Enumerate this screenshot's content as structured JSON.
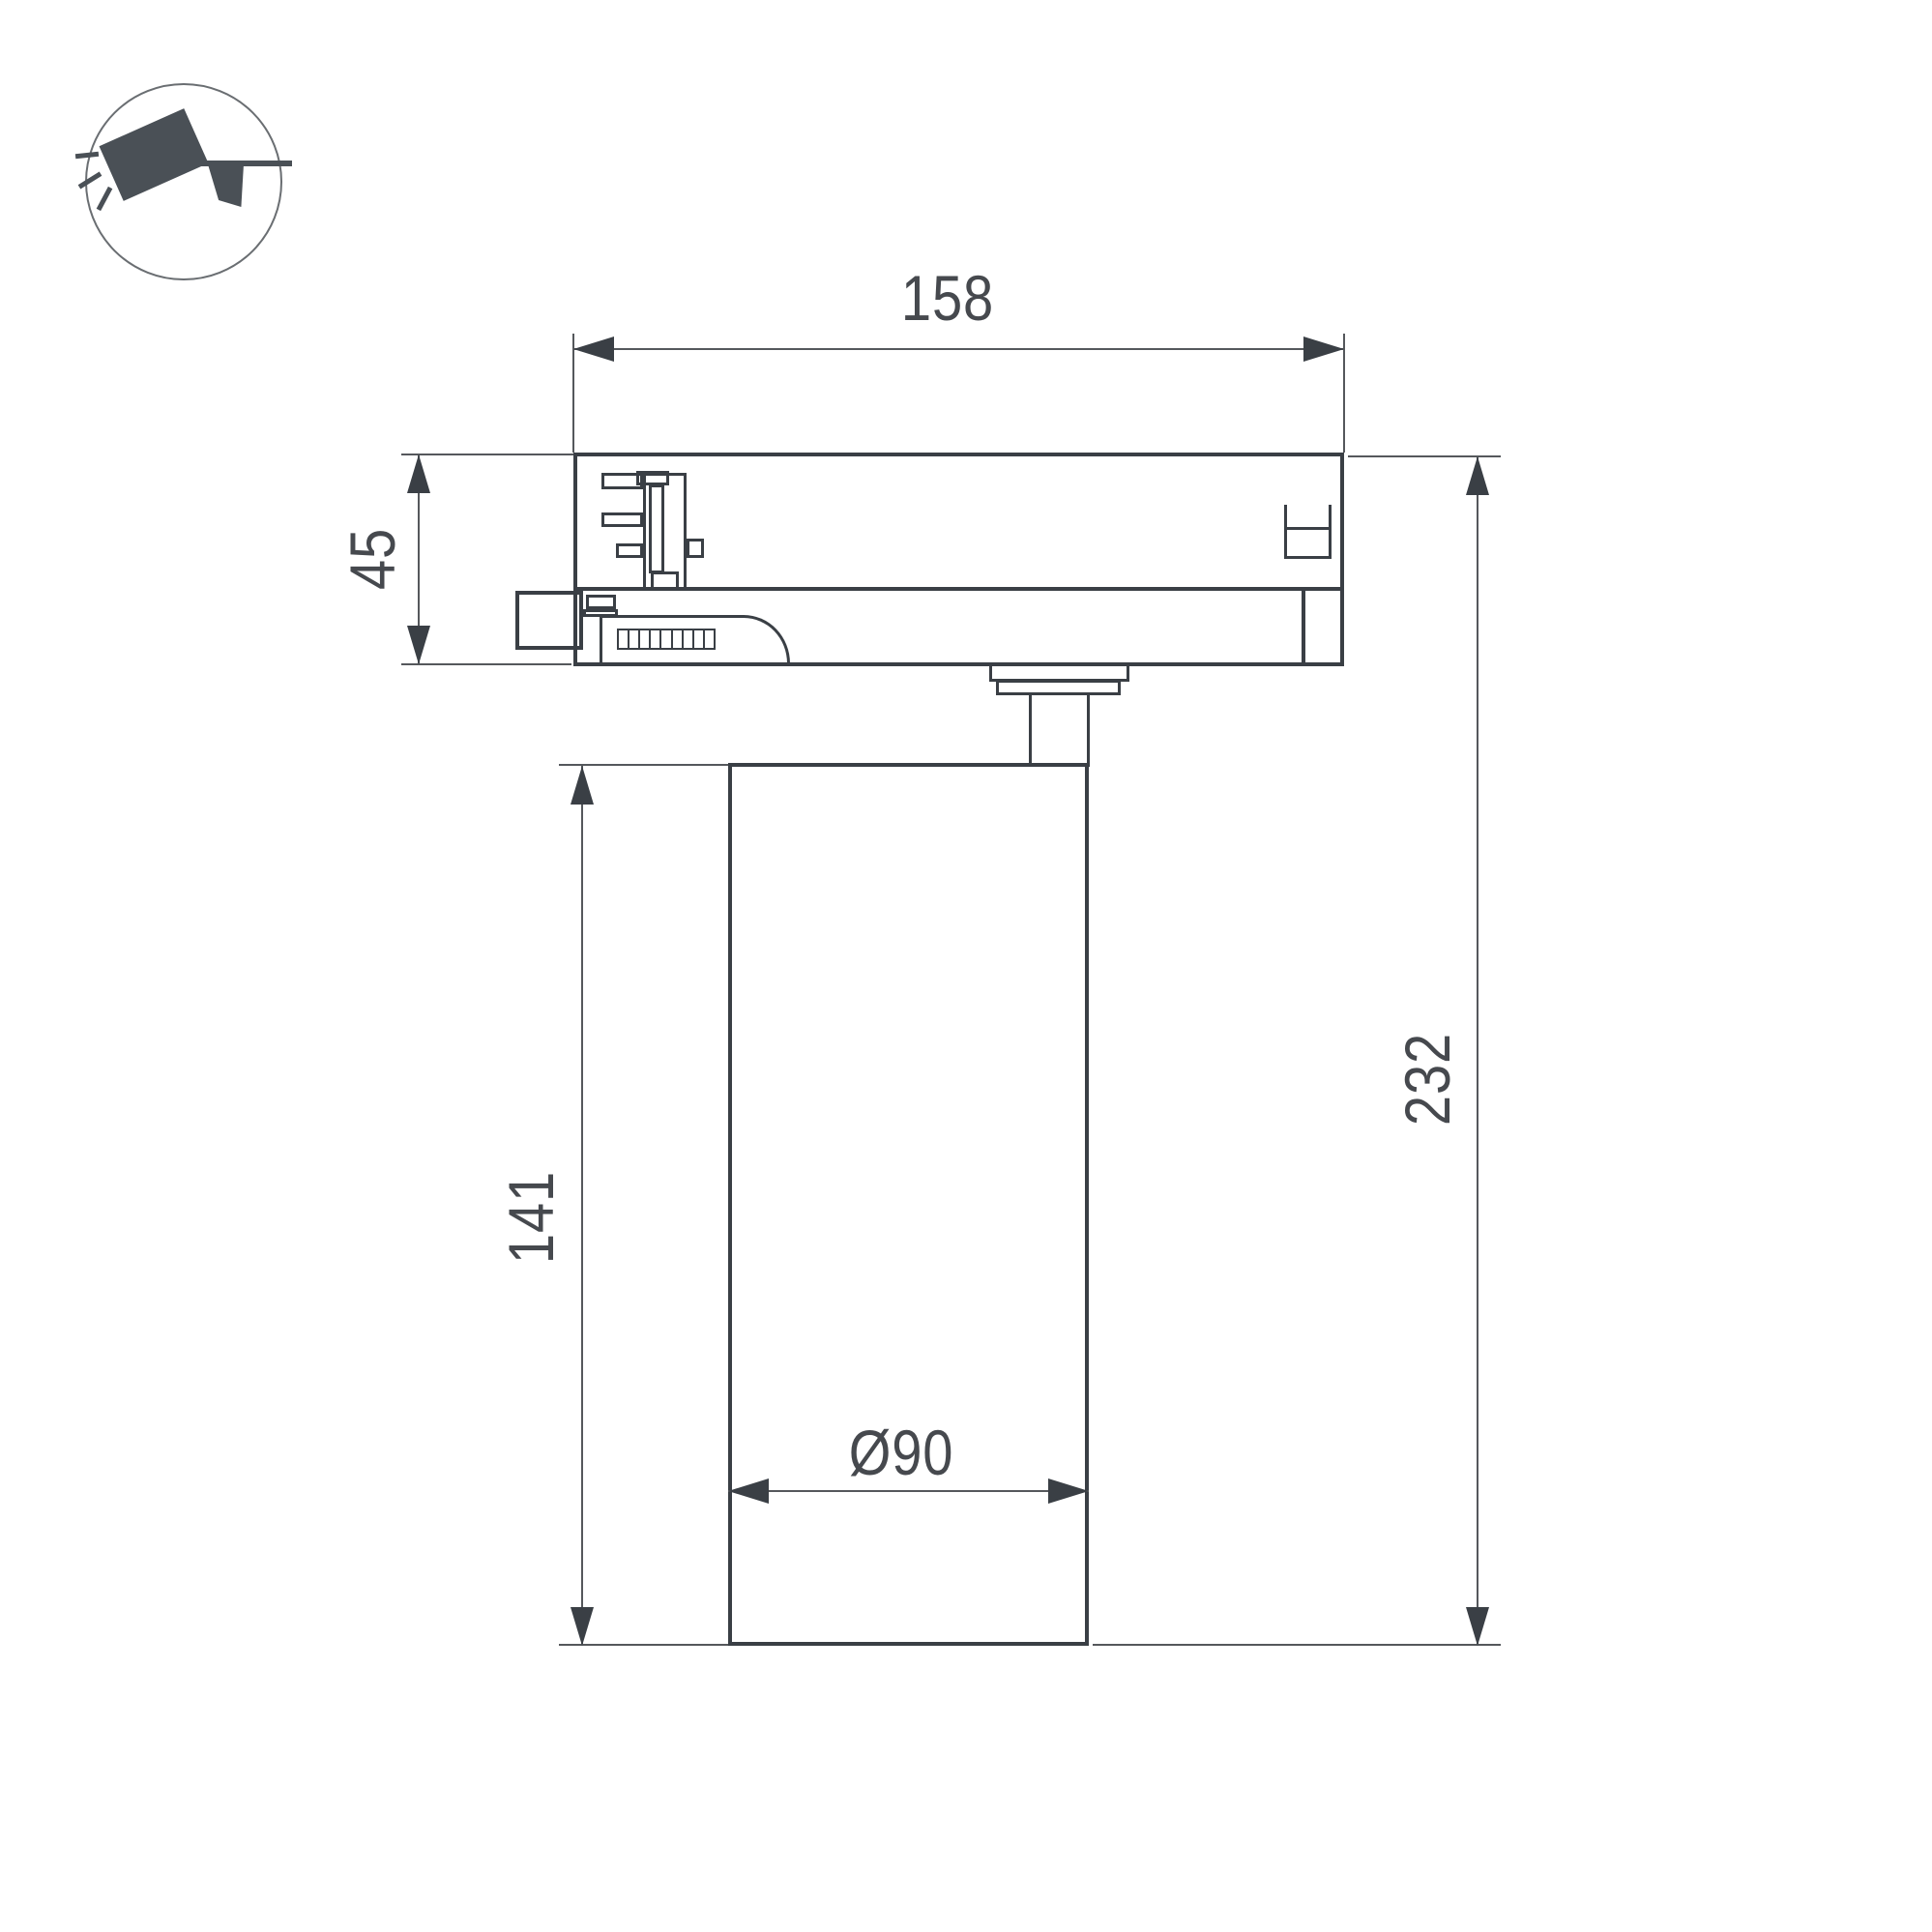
{
  "meta": {
    "type": "technical-dimension-drawing",
    "subject": "LED track spotlight side view with dimensions"
  },
  "dimensions": {
    "track_adapter_width": "158",
    "track_adapter_height": "45",
    "body_height": "141",
    "total_height": "232",
    "body_diameter": "Ø90"
  },
  "icon": {
    "name": "track-spotlight"
  },
  "colors": {
    "outline": "#3a3f45",
    "dimension": "#55585c",
    "text": "#46494e",
    "icon": "#4a5056"
  }
}
